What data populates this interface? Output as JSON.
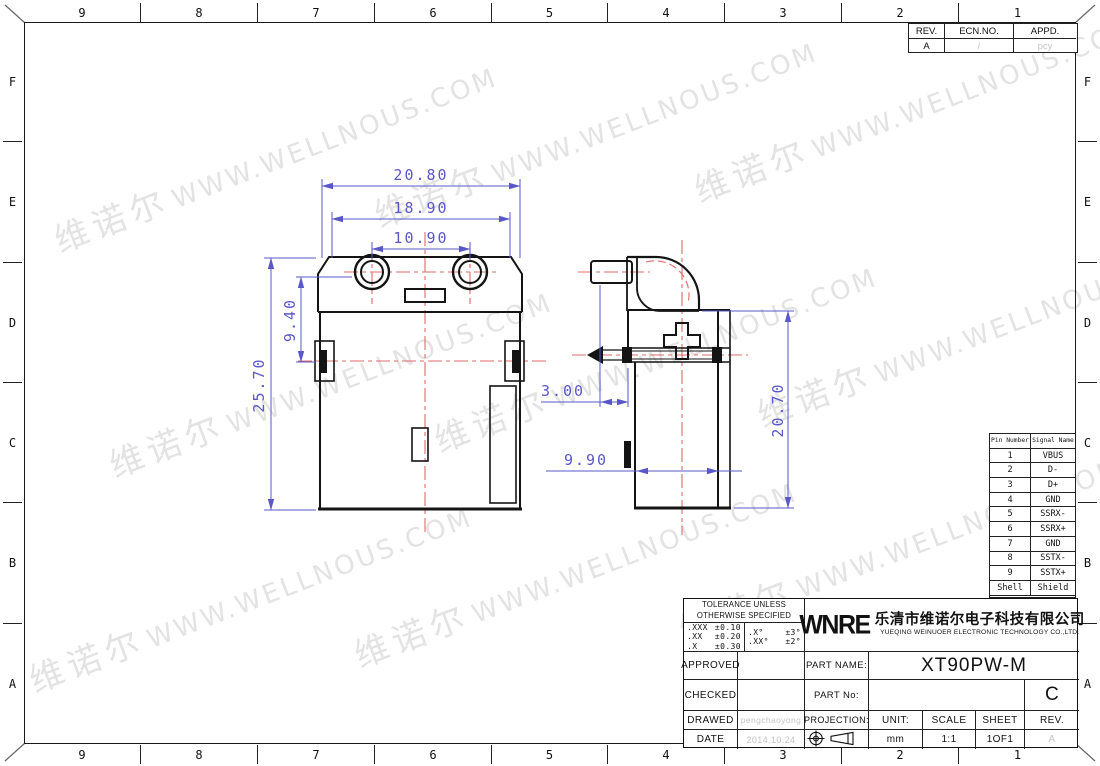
{
  "border": {
    "columns": [
      "9",
      "8",
      "7",
      "6",
      "5",
      "4",
      "3",
      "2",
      "1"
    ],
    "rows": [
      "F",
      "E",
      "D",
      "C",
      "B",
      "A"
    ]
  },
  "revision_table": {
    "rev_header": "REV.",
    "ecn_header": "ECN.NO.",
    "appd_header": "APPD.",
    "rev": "A",
    "ecn": "/",
    "appd": "pcy"
  },
  "watermark": {
    "cn": "维诺尔",
    "url": "WWW.WELLNOUS.COM"
  },
  "dimensions": {
    "front_width_overall": "20.80",
    "front_width_mid": "18.90",
    "front_hole_spacing": "10.90",
    "front_height_top": "9.40",
    "front_height_overall": "25.70",
    "side_offset": "3.00",
    "side_depth": "9.90",
    "side_height": "20.70"
  },
  "pin_table": {
    "col1_header": "Pin Number",
    "col2_header": "Signal Name",
    "rows": [
      [
        "1",
        "VBUS"
      ],
      [
        "2",
        "D-"
      ],
      [
        "3",
        "D+"
      ],
      [
        "4",
        "GND"
      ],
      [
        "5",
        "SSRX-"
      ],
      [
        "6",
        "SSRX+"
      ],
      [
        "7",
        "GND"
      ],
      [
        "8",
        "SSTX-"
      ],
      [
        "9",
        "SSTX+"
      ],
      [
        "Shell",
        "Shield"
      ]
    ]
  },
  "title_block": {
    "tolerance_title_1": "TOLERANCE UNLESS",
    "tolerance_title_2": "OTHERWISE SPECIFIED",
    "linear": [
      {
        "d": ".XXX",
        "t": "±0.10"
      },
      {
        "d": ".XX",
        "t": "±0.20"
      },
      {
        "d": ".X",
        "t": "±0.30"
      }
    ],
    "angular": [
      {
        "d": ".X°",
        "t": "±3°"
      },
      {
        "d": ".XX°",
        "t": "±2°"
      }
    ],
    "approved_label": "APPROVED",
    "approved_value": "",
    "checked_label": "CHECKED",
    "checked_value": "",
    "drawed_label": "DRAWED",
    "drawed_value": "pengchaoyong",
    "date_label": "DATE",
    "date_value": "2014.10.24",
    "logo": "WNRE",
    "company_cn": "乐清市维诺尔电子科技有限公司",
    "company_en": "YUEQING WEINUOER ELECTRONIC TECHNOLOGY CO.,LTD.",
    "part_name_label": "PART NAME:",
    "part_name": "XT90PW-M",
    "part_no_label": "PART No:",
    "part_no": "",
    "size_code": "C",
    "projection_label": "PROJECTION:",
    "unit_label": "UNIT:",
    "unit": "mm",
    "scale_label": "SCALE",
    "scale": "1:1",
    "sheet_label": "SHEET",
    "sheet": "1OF1",
    "rev_label": "REV.",
    "rev": "A"
  },
  "colors": {
    "dimension": "#5a58c8",
    "centerline": "#e06a6a",
    "watermark": "#e3e3e3",
    "muted": "#c3c3c3"
  }
}
